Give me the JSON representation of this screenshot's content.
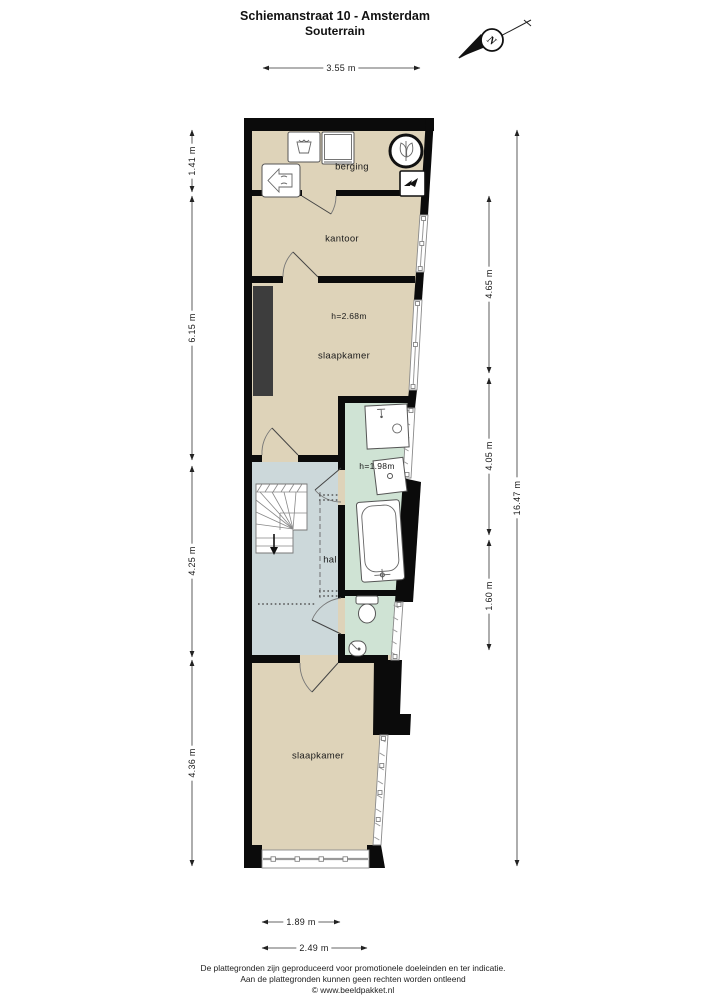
{
  "title": "Schiemanstraat 10 - Amsterdam",
  "subtitle": "Souterrain",
  "compass": {
    "letter": "N"
  },
  "rooms": {
    "berging": "berging",
    "kantoor": "kantoor",
    "slaapkamer_top": "slaapkamer",
    "hal": "hal",
    "slaapkamer_bottom": "slaapkamer"
  },
  "heights": {
    "slaapkamer": "h=2.68m",
    "badkamer": "h=1.98m"
  },
  "dimensions": {
    "top": "3.55 m",
    "left": [
      "1.41 m",
      "6.15 m",
      "4.25 m",
      "4.36 m"
    ],
    "right_inner": [
      "4.65 m",
      "4.05 m",
      "1.60 m"
    ],
    "right_outer": "16.47 m",
    "bottom": [
      "1.89 m",
      "2.49 m"
    ]
  },
  "footer": {
    "line1": "De plattegronden zijn geproduceerd voor promotionele doeleinden en ter indicatie.",
    "line2": "Aan de plattegronden kunnen geen rechten worden ontleend",
    "line3": "© www.beeldpakket.nl"
  },
  "icons": {
    "compass": "north-arrow",
    "berging": [
      "washing-machine",
      "dryer",
      "mechanical-ventilation-unit",
      "heater-unit",
      "electric-meter"
    ],
    "badkamer": [
      "washbasin",
      "shower",
      "bathtub"
    ],
    "toilet": [
      "toilet",
      "corner-sink"
    ],
    "stairs": "staircase-down"
  },
  "colors": {
    "wall": "#0b0b0b",
    "room_beige": "#ded3b9",
    "room_green": "#cfe3d4",
    "room_gray": "#ccd8da",
    "chimney": "#3d3d3d"
  }
}
